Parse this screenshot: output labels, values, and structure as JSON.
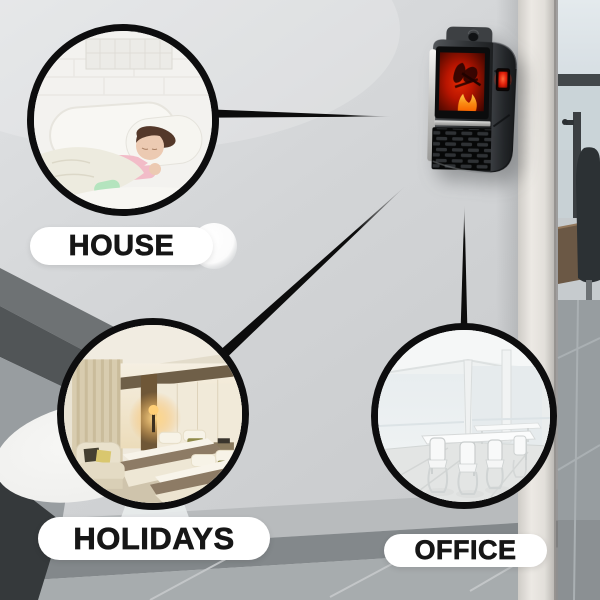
{
  "title": "plug-in flame heater use-case infographic",
  "product": {
    "name": "wall-outlet-flame-display-heater",
    "parts": [
      "mounting-tab",
      "flame-display-screen",
      "led-power-display",
      "heat-vent-grille"
    ],
    "mounted_on": "light-gray-wall"
  },
  "use_cases": [
    {
      "id": "house",
      "label": "HOUSE",
      "scene": "child-sleeping-in-white-bed-photo"
    },
    {
      "id": "holidays",
      "label": "HOLIDAYS",
      "scene": "hotel-twin-bed-room-photo"
    },
    {
      "id": "office",
      "label": "OFFICE",
      "scene": "bright-meeting-room-photo"
    }
  ],
  "connectors": [
    {
      "from": "house-circle",
      "to": "heater",
      "style": "tapered-black-line"
    },
    {
      "from": "holidays-circle",
      "to": "heater",
      "style": "tapered-black-line"
    },
    {
      "from": "office-circle",
      "to": "heater",
      "style": "tapered-black-line"
    }
  ],
  "colors": {
    "wall": "#d3d5d7",
    "connector_line": "#0c0c0c",
    "circle_border": "#0d0d0e",
    "label_background": "#ffffff",
    "label_text": "#161616",
    "flame_red": "#c81402",
    "flame_orange": "#ff8a00",
    "heater_body": "#26282b"
  }
}
